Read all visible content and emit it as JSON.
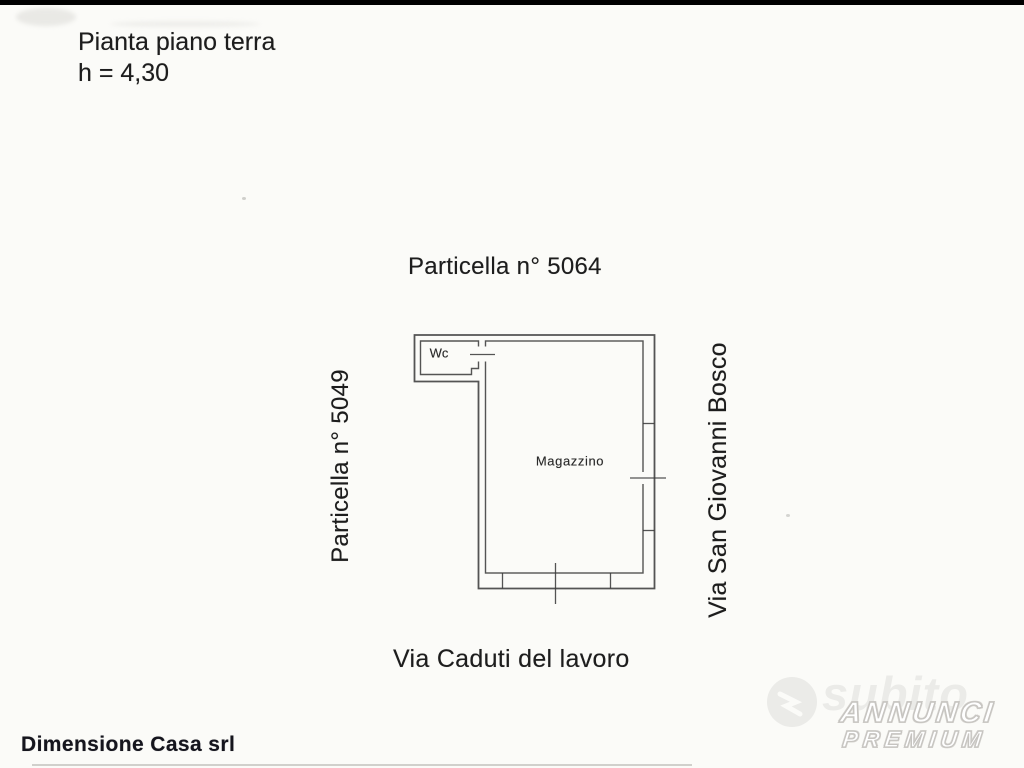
{
  "scan": {
    "header_line1": "Pianta piano terra",
    "header_line2": "h = 4,30",
    "parcel_title": "Particella n° 5064",
    "left_parcel_label": "Particella n° 5049",
    "right_street_label": "Via San Giovanni Bosco",
    "bottom_street_label": "Via Caduti del lavoro",
    "room_wc": "Wc",
    "room_main": "Magazzino",
    "footer_company": "Dimensione Casa srl"
  },
  "watermarks": {
    "brand": "subito",
    "badge_line1": "ANNUNCI",
    "badge_line2": "PREMIUM"
  },
  "colors": {
    "paper": "#fbfbf8",
    "ink": "#1d1d1d",
    "plan_line": "#3c3c3c",
    "watermark_gray": "#ebeae7",
    "badge_outline": "#c6c4c0"
  }
}
